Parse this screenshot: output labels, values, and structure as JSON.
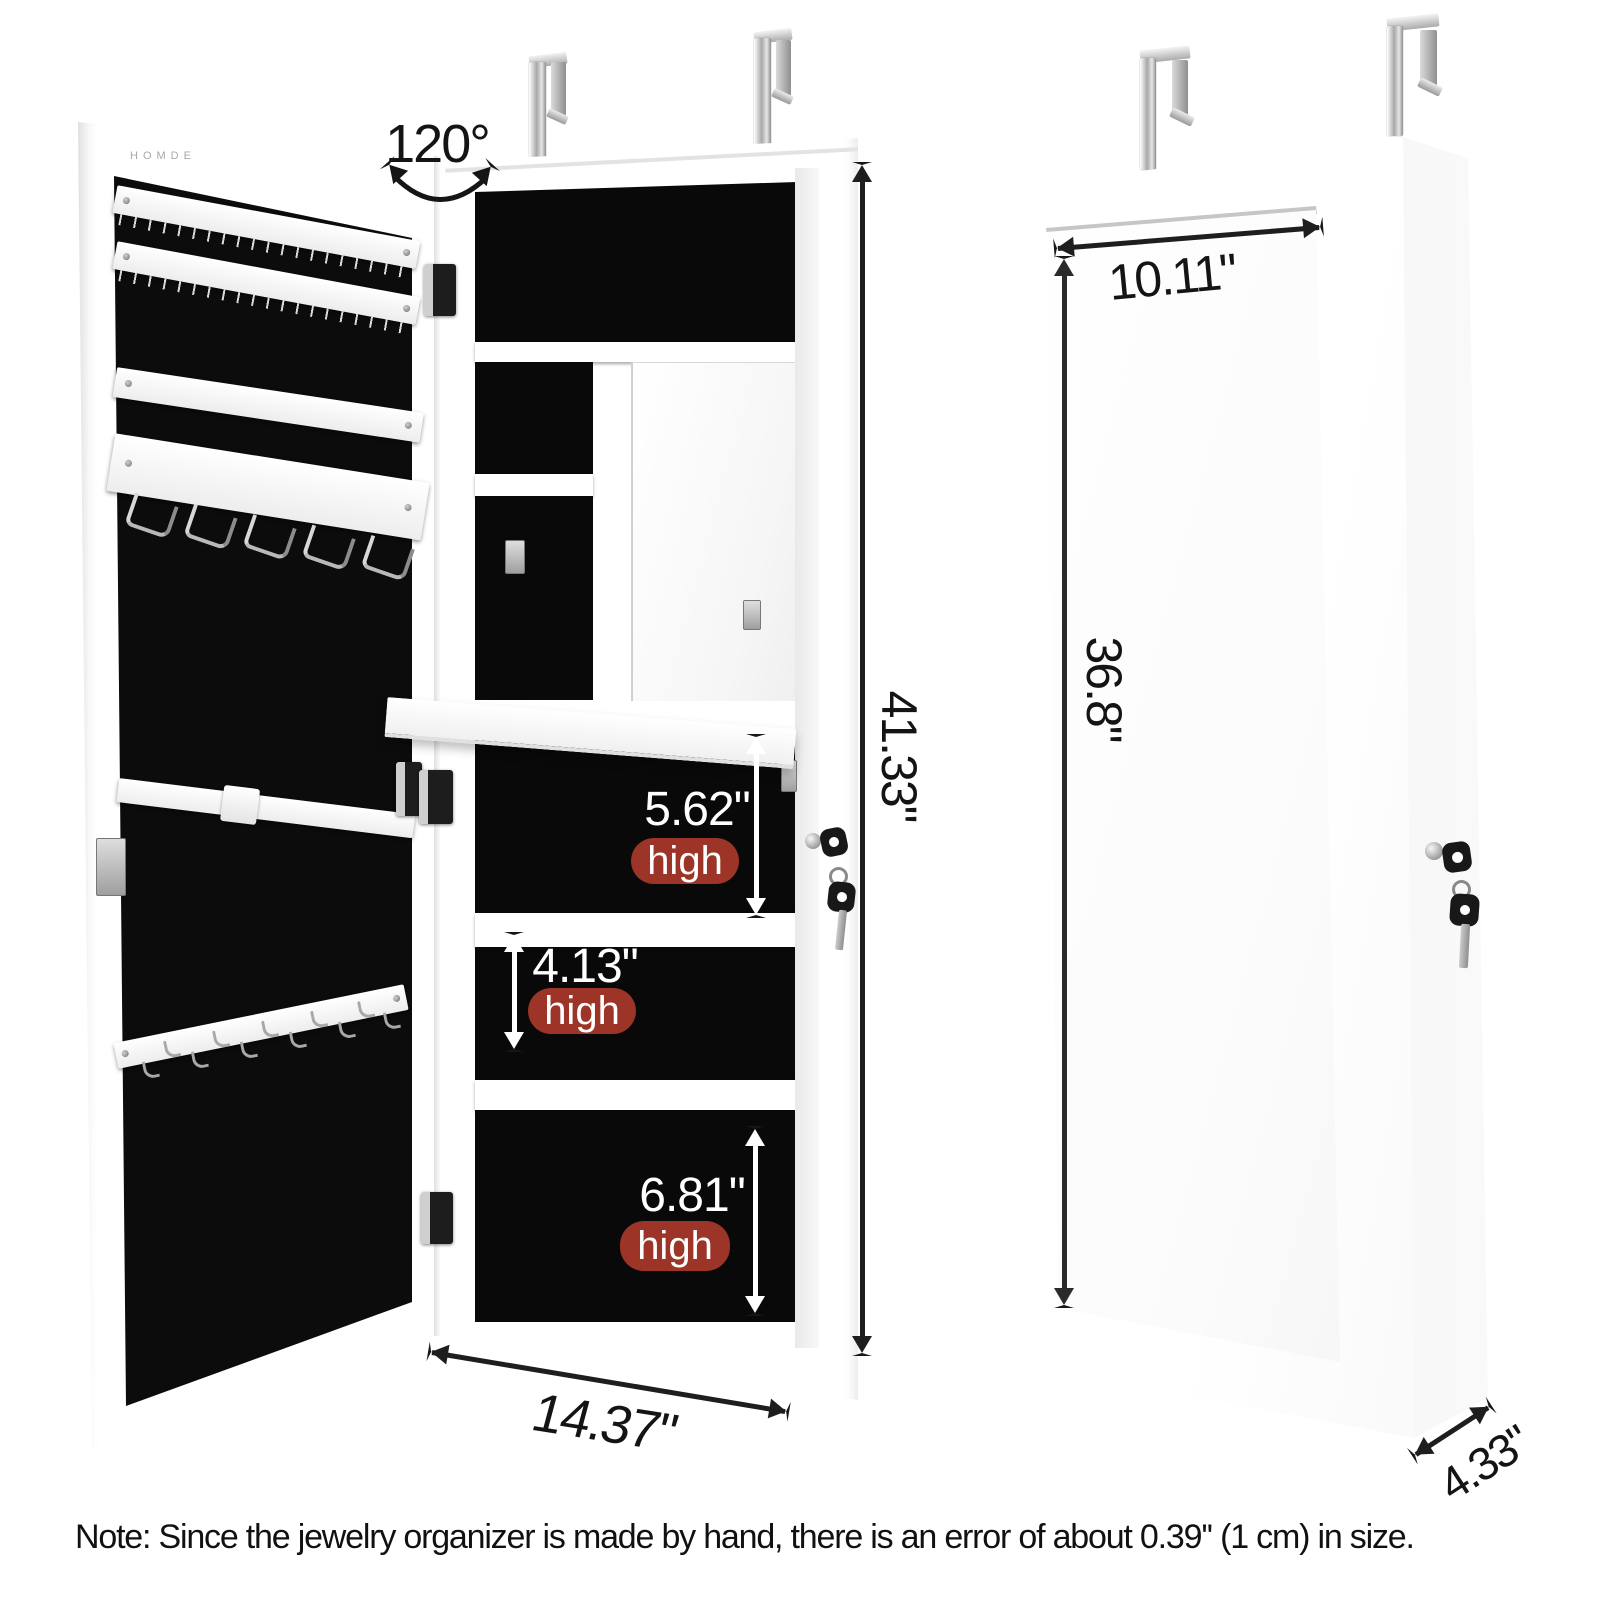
{
  "left_cabinet": {
    "brand": "HOMDE",
    "open_angle": "120°",
    "height": "41.33\"",
    "width": "14.37\"",
    "compartments": [
      {
        "value": "5.62\"",
        "label": "high"
      },
      {
        "value": "4.13\"",
        "label": "high"
      },
      {
        "value": "6.81\"",
        "label": "high"
      }
    ]
  },
  "right_cabinet": {
    "mirror_width": "10.11\"",
    "mirror_height": "36.8\"",
    "depth": "4.33\""
  },
  "note": "Note: Since the jewelry organizer is made by hand, there is an error of about 0.39'' (1 cm) in size.",
  "colors": {
    "badge_red": "#9c3427",
    "felt_black": "#0c0c0c",
    "arrow_black": "#1e1e1e",
    "chrome": "#b9b9b9",
    "cabinet_white": "#ffffff"
  },
  "icons": {
    "over-door-hanger": "chrome-strap",
    "lock": "cylinder-lock",
    "key": "key-silhouette",
    "hinge": "barrel-hinge",
    "necklace-hook": "j-hook",
    "wire-hook": "u-loop"
  }
}
